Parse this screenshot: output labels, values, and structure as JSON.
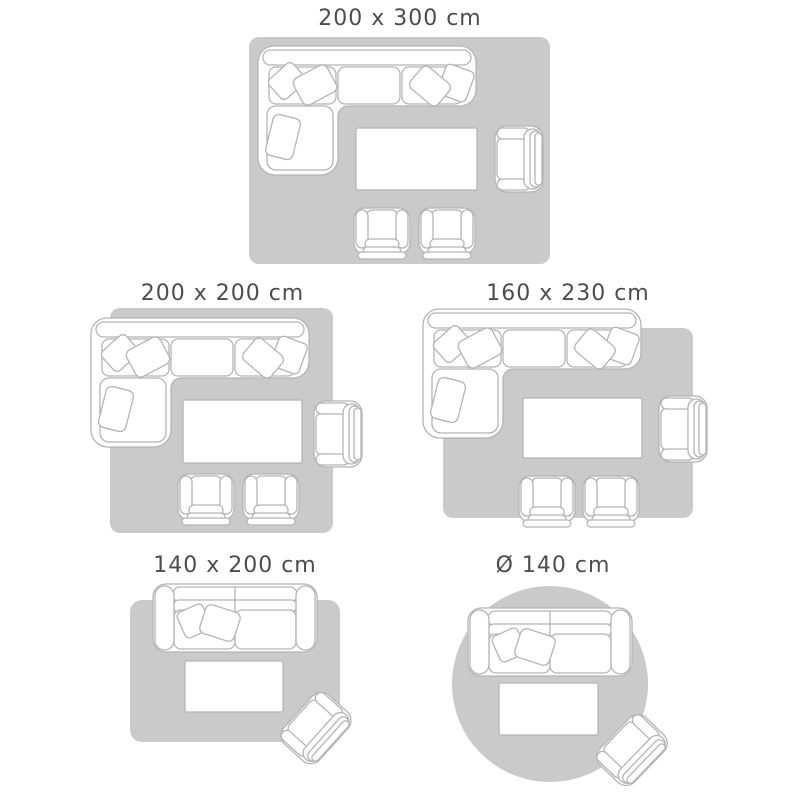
{
  "title": "Rug size guide",
  "colors": {
    "rug": "#cacaca",
    "line": "#b5b5b5",
    "fill": "#ffffff",
    "label": "#4d4d4d"
  },
  "diagrams": [
    {
      "id": "200x300",
      "label": "200 x 300 cm",
      "shape": "rectangle"
    },
    {
      "id": "200x200",
      "label": "200 x 200 cm",
      "shape": "rectangle"
    },
    {
      "id": "160x230",
      "label": "160 x 230 cm",
      "shape": "rectangle"
    },
    {
      "id": "140x200",
      "label": "140 x 200 cm",
      "shape": "rectangle"
    },
    {
      "id": "d140",
      "label": "Ø 140 cm",
      "shape": "circle"
    }
  ],
  "icons": [
    "corner-sofa-icon",
    "two-seat-sofa-icon",
    "armchair-icon",
    "club-chair-icon",
    "coffee-table-icon",
    "rug-icon"
  ]
}
